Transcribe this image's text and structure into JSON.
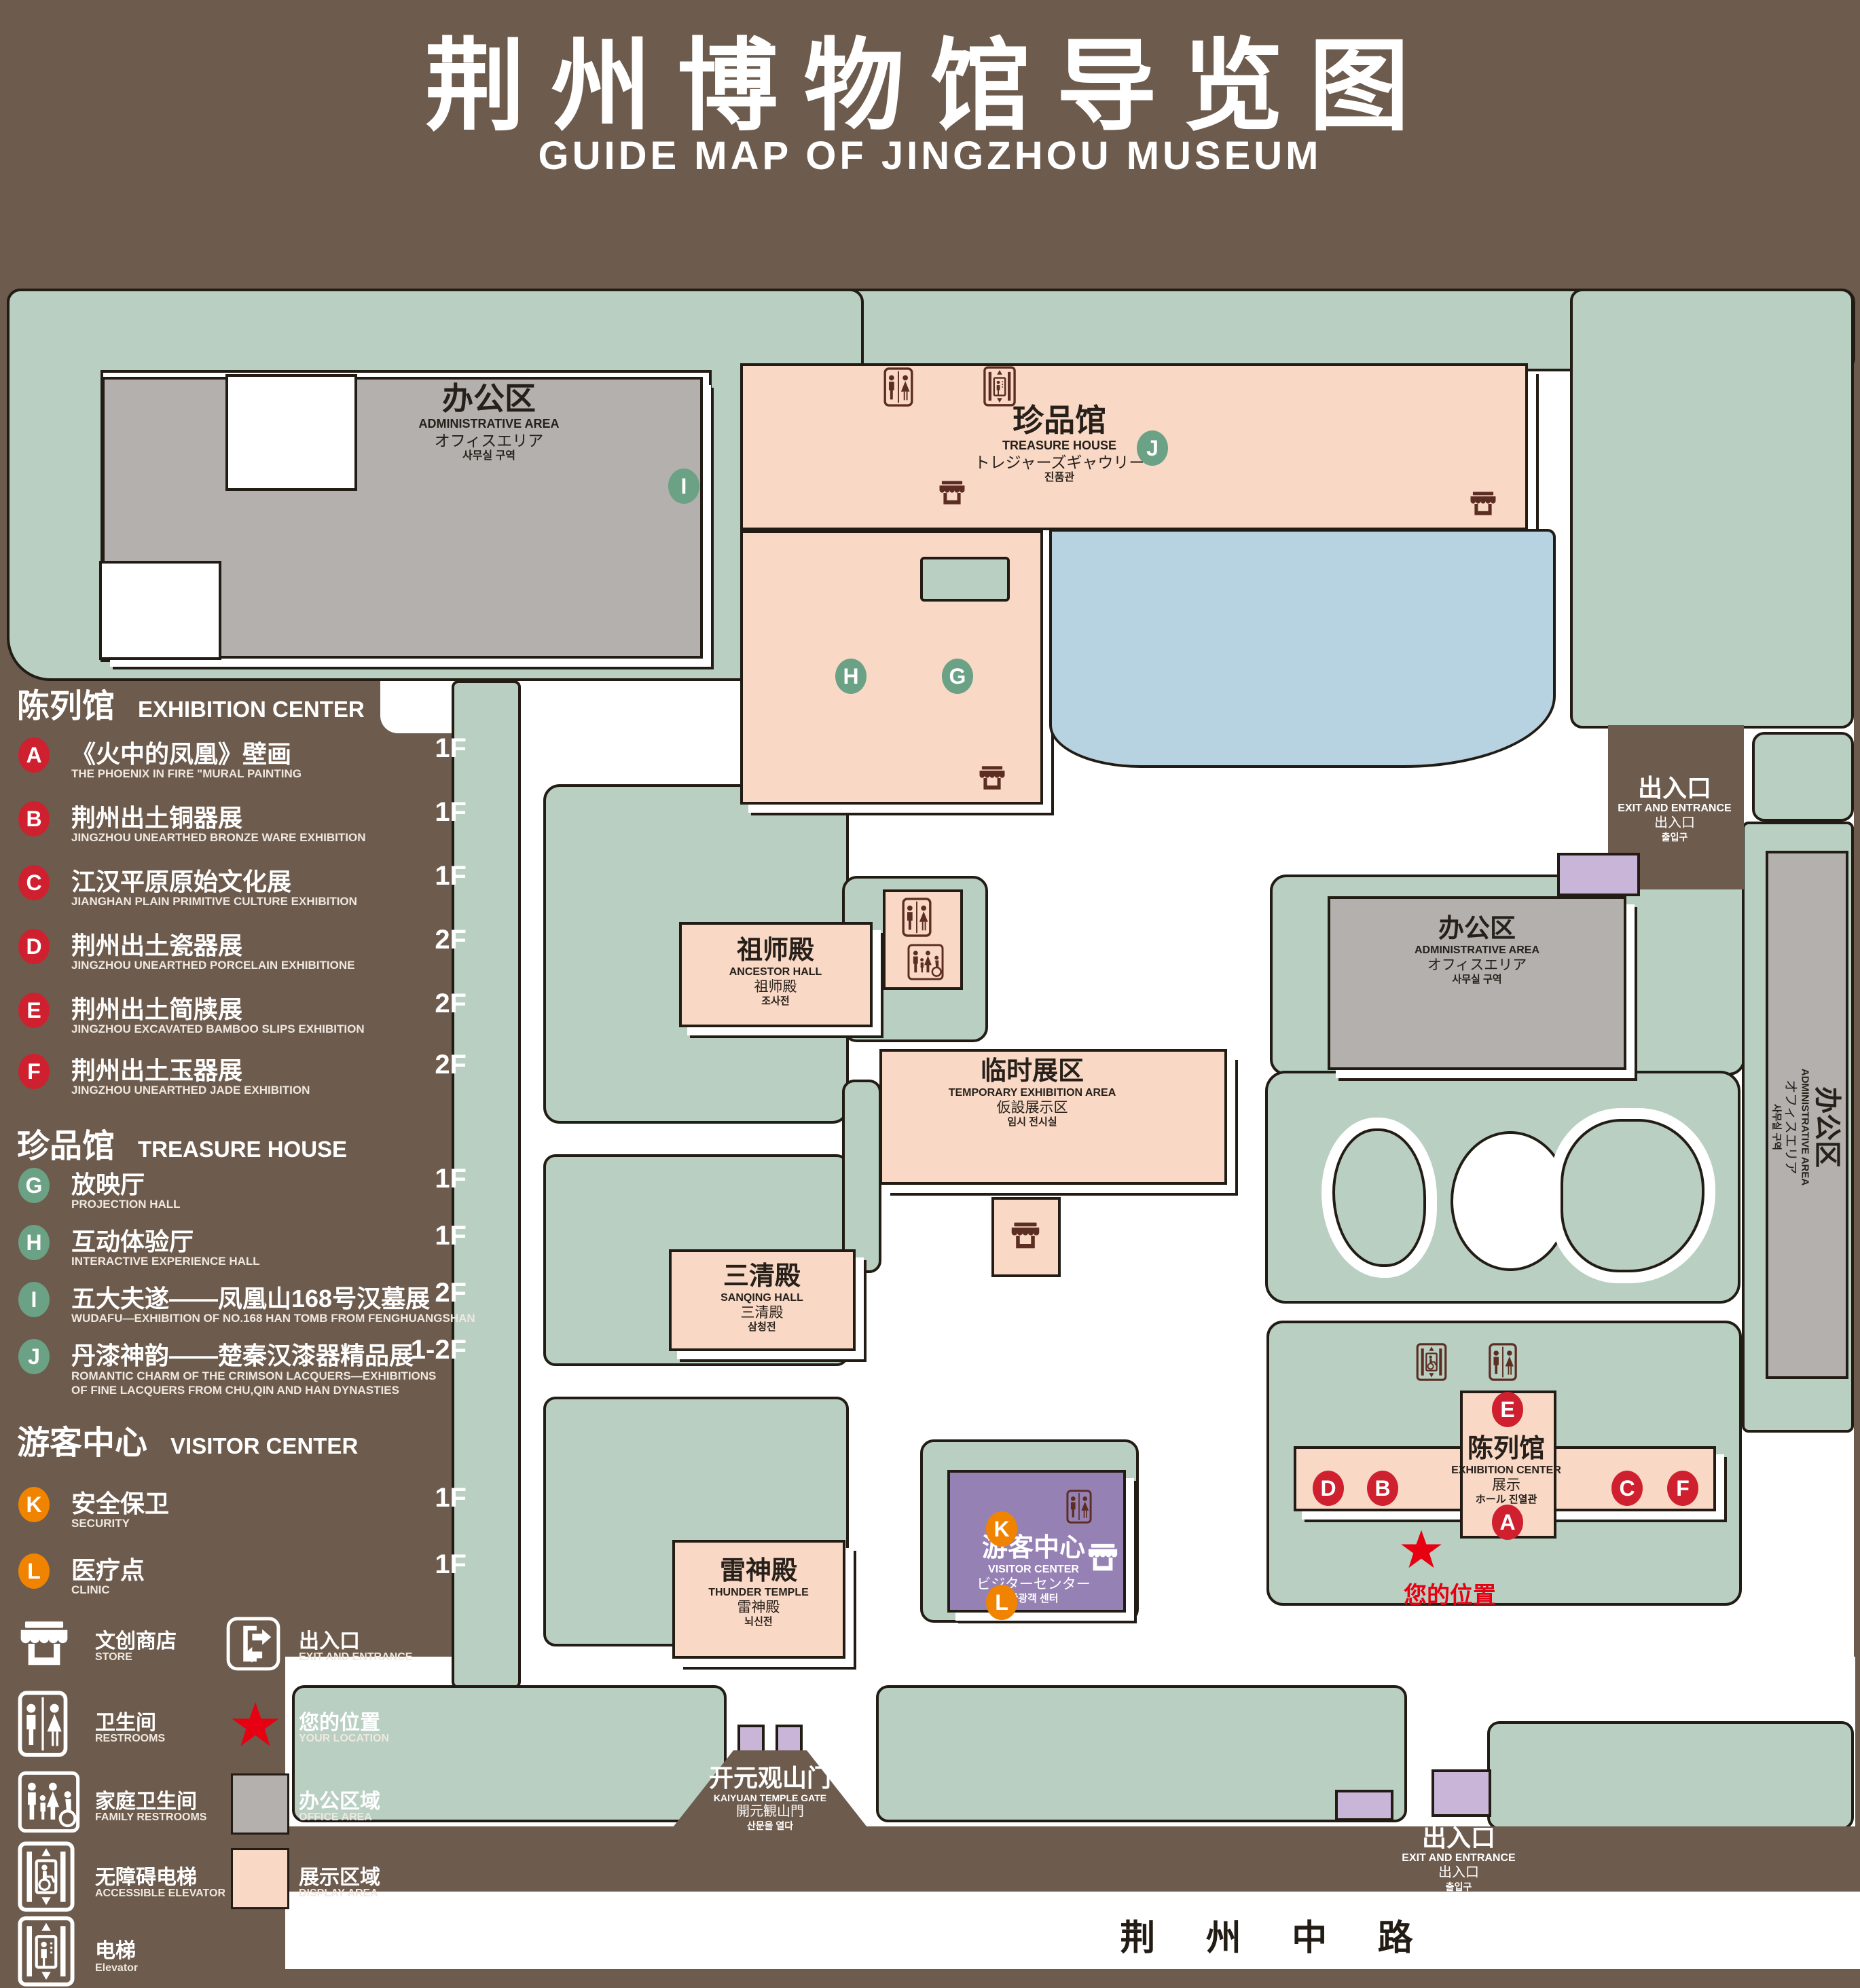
{
  "title": {
    "zh": "荆州博物馆导览图",
    "en": "GUIDE MAP OF JINGZHOU MUSEUM"
  },
  "markers": {
    "A": "A",
    "B": "B",
    "C": "C",
    "D": "D",
    "E": "E",
    "F": "F",
    "G": "G",
    "H": "H",
    "I": "I",
    "J": "J",
    "K": "K",
    "L": "L"
  },
  "legend": {
    "exhibition": {
      "zh": "陈列馆",
      "en": "EXHIBITION CENTER",
      "items": [
        {
          "letter": "A",
          "zh": "《火中的凤凰》壁画",
          "en": "THE PHOENIX IN FIRE \"MURAL PAINTING",
          "floor": "1F"
        },
        {
          "letter": "B",
          "zh": "荆州出土铜器展",
          "en": "JINGZHOU UNEARTHED BRONZE WARE EXHIBITION",
          "floor": "1F"
        },
        {
          "letter": "C",
          "zh": "江汉平原原始文化展",
          "en": "JIANGHAN PLAIN PRIMITIVE CULTURE EXHIBITION",
          "floor": "1F"
        },
        {
          "letter": "D",
          "zh": "荆州出土瓷器展",
          "en": "JINGZHOU UNEARTHED PORCELAIN EXHIBITIONE",
          "floor": "2F"
        },
        {
          "letter": "E",
          "zh": "荆州出土简牍展",
          "en": "JINGZHOU EXCAVATED BAMBOO SLIPS EXHIBITION",
          "floor": "2F"
        },
        {
          "letter": "F",
          "zh": "荆州出土玉器展",
          "en": "JINGZHOU UNEARTHED JADE EXHIBITION",
          "floor": "2F"
        }
      ]
    },
    "treasure": {
      "zh": "珍品馆",
      "en": "TREASURE HOUSE",
      "items": [
        {
          "letter": "G",
          "zh": "放映厅",
          "en": "PROJECTION HALL",
          "floor": "1F"
        },
        {
          "letter": "H",
          "zh": "互动体验厅",
          "en": "INTERACTIVE EXPERIENCE HALL",
          "floor": "1F"
        },
        {
          "letter": "I",
          "zh": "五大夫遂——凤凰山168号汉墓展",
          "en": "WUDAFU—EXHIBITION OF NO.168 HAN TOMB FROM FENGHUANGSHAN",
          "floor": "2F"
        },
        {
          "letter": "J",
          "zh": "丹漆神韵——楚秦汉漆器精品展",
          "en": "ROMANTIC CHARM OF THE CRIMSON LACQUERS—EXHIBITIONS OF FINE LACQUERS FROM CHU,QIN AND HAN DYNASTIES",
          "floor": "1-2F"
        }
      ]
    },
    "visitor": {
      "zh": "游客中心",
      "en": "VISITOR CENTER",
      "items": [
        {
          "letter": "K",
          "zh": "安全保卫",
          "en": "SECURITY",
          "floor": "1F"
        },
        {
          "letter": "L",
          "zh": "医疗点",
          "en": "CLINIC",
          "floor": "1F"
        }
      ]
    },
    "facilities": {
      "store": {
        "zh": "文创商店",
        "en": "STORE"
      },
      "exit": {
        "zh": "出入口",
        "en": "EXIT AND ENTRANCE"
      },
      "restroom": {
        "zh": "卫生间",
        "en": "RESTROOMS"
      },
      "location": {
        "zh": "您的位置",
        "en": "YOUR LOCATION"
      },
      "family_restroom": {
        "zh": "家庭卫生间",
        "en": "FAMILY RESTROOMS"
      },
      "office_area": {
        "zh": "办公区域",
        "en": "OFFICE AREA"
      },
      "accessible_elevator": {
        "zh": "无障碍电梯",
        "en": "ACCESSIBLE ELEVATOR"
      },
      "display_area": {
        "zh": "展示区域",
        "en": "DISPLAY AREA"
      },
      "elevator": {
        "zh": "电梯",
        "en": "Elevator"
      }
    }
  },
  "map": {
    "admin_top_left": {
      "zh": "办公区",
      "en": "ADMINISTRATIVE AREA",
      "ja": "オフィスエリア",
      "ko": "사무실 구역"
    },
    "treasure_house": {
      "zh": "珍品馆",
      "en": "TREASURE HOUSE",
      "ja": "トレジャーズギャウリー",
      "ko": "진품관"
    },
    "exit_ne": {
      "zh": "出入口",
      "en": "EXIT AND ENTRANCE",
      "ja": "出入口",
      "ko": "출입구"
    },
    "admin_mid": {
      "zh": "办公区",
      "en": "ADMINISTRATIVE AREA",
      "ja": "オフィスエリア",
      "ko": "사무실 구역"
    },
    "admin_right": {
      "zh": "办公区",
      "en": "ADMINISTRATIVE AREA",
      "ja": "オフィスエリア",
      "ko": "사무실 구역"
    },
    "ancestor_hall": {
      "zh": "祖师殿",
      "en": "ANCESTOR HALL",
      "ja": "祖师殿",
      "ko": "조사전"
    },
    "temporary_area": {
      "zh": "临时展区",
      "en": "TEMPORARY EXHIBITION AREA",
      "ja": "仮設展示区",
      "ko": "임시 전시실"
    },
    "sanqing_hall": {
      "zh": "三清殿",
      "en": "SANQING HALL",
      "ja": "三清殿",
      "ko": "삼청전"
    },
    "thunder_temple": {
      "zh": "雷神殿",
      "en": "THUNDER TEMPLE",
      "ja": "雷神殿",
      "ko": "뇌신전"
    },
    "visitor_center": {
      "zh": "游客中心",
      "en": "VISITOR CENTER",
      "ja": "ビジターセンター",
      "ko": "관광객 센터"
    },
    "exhibition_center": {
      "zh": "陈列馆",
      "en": "EXHIBITION CENTER",
      "ja": "展示",
      "ko": "ホール 진열관"
    },
    "gate": {
      "zh": "开元观山门",
      "en": "KAIYUAN TEMPLE GATE",
      "ja": "開元観山門",
      "ko": "산문을 열다"
    },
    "exit_s": {
      "zh": "出入口",
      "en": "EXIT AND ENTRANCE",
      "ja": "出入口",
      "ko": "출입구"
    },
    "your_location": {
      "zh": "您的位置"
    },
    "road": {
      "zh": "荆 州 中 路"
    }
  },
  "colors": {
    "background": "#6d5b4d",
    "lawn": "#b9cfc2",
    "display_area": "#f9d9c6",
    "office_area": "#b4b0ad",
    "water": "#b7d2e0",
    "visitor_center": "#9681b4",
    "gate_block": "#c9b5d8",
    "icon": "#5c2d22",
    "marker_red": "#cf2030",
    "marker_green": "#6ba184",
    "marker_orange": "#f08300",
    "location_red": "#e60012"
  }
}
